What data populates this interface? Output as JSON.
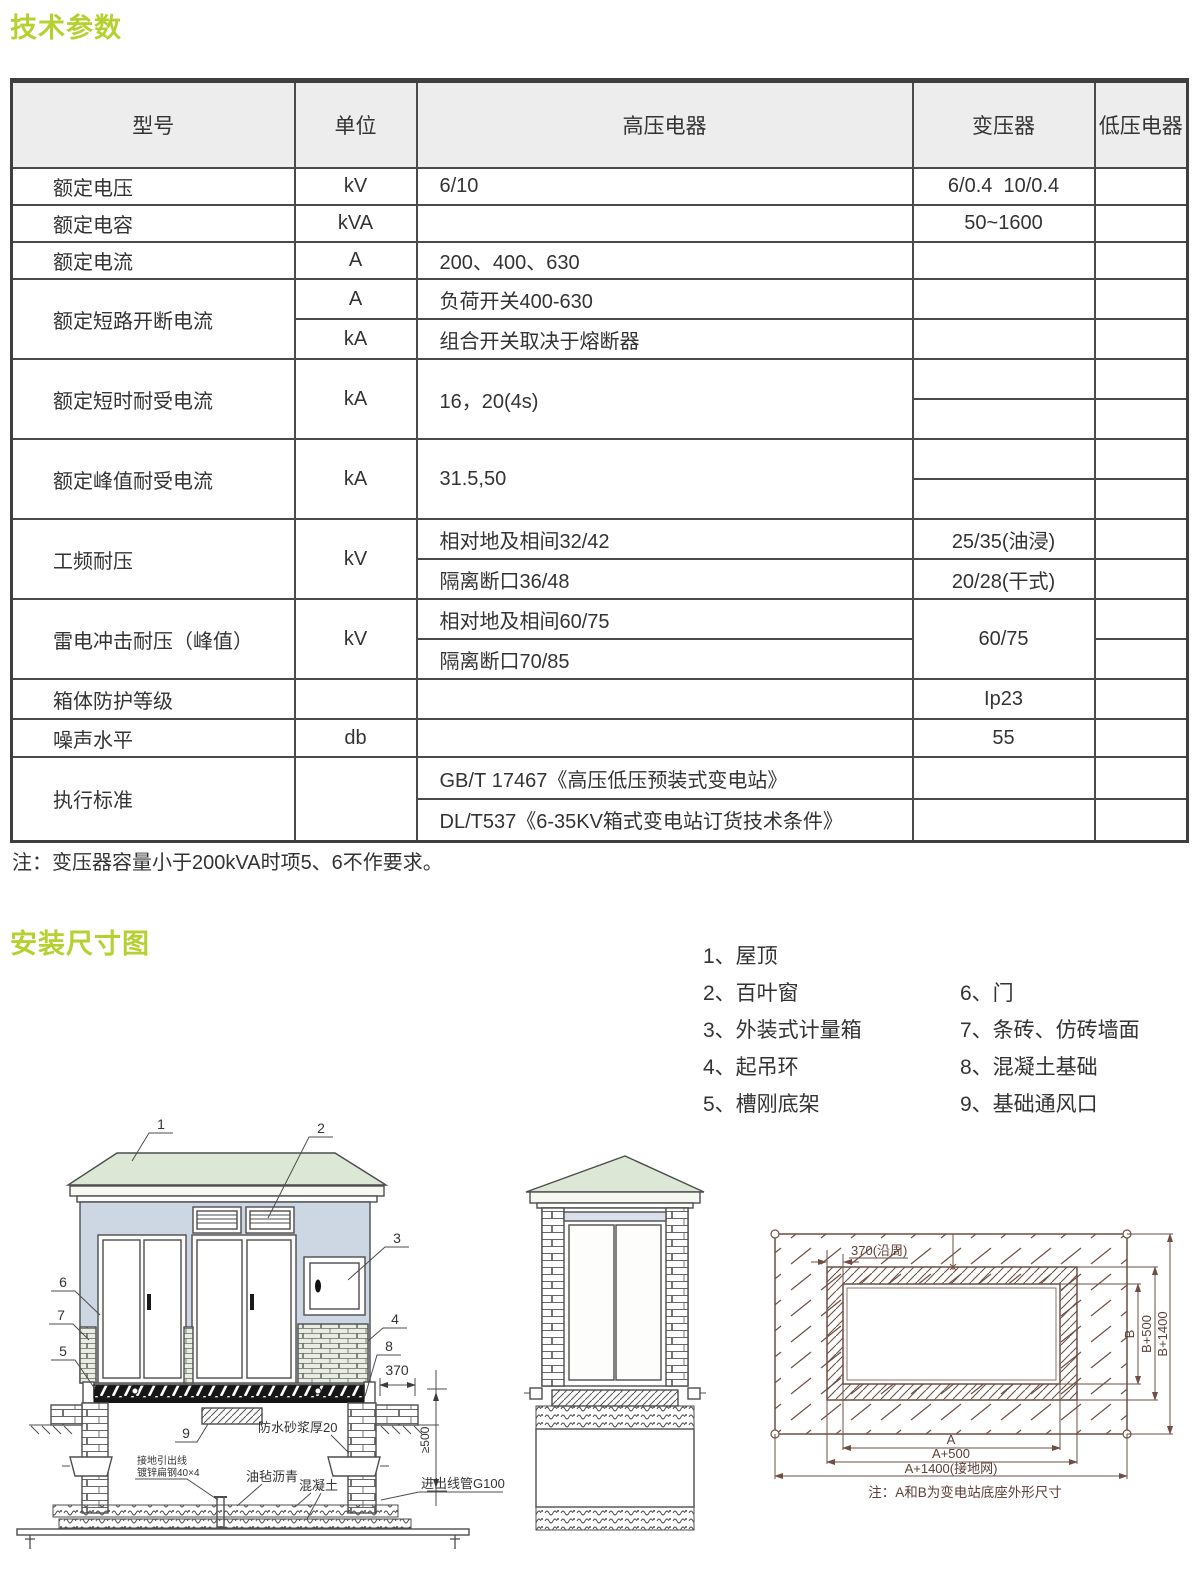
{
  "page": {
    "title1": "技术参数",
    "title2": "安装尺寸图",
    "table_note": "注：变压器容量小于200kVA时项5、6不作要求。"
  },
  "table": {
    "headers": [
      "型号",
      "单位",
      "高压电器",
      "变压器",
      "低压电器"
    ],
    "rated_voltage": {
      "name": "额定电压",
      "unit": "kV",
      "hv": "6/10",
      "tx": "6/0.4  10/0.4"
    },
    "rated_capacity": {
      "name": "额定电容",
      "unit": "kVA",
      "tx": "50~1600"
    },
    "rated_current": {
      "name": "额定电流",
      "unit": "A",
      "hv": "200、400、630"
    },
    "rated_breaking": {
      "name": "额定短路开断电流",
      "unit_a": "A",
      "hv_a": "负荷开关400-630",
      "unit_b": "kA",
      "hv_b": "组合开关取决于熔断器"
    },
    "short_time": {
      "name": "额定短时耐受电流",
      "unit": "kA",
      "hv": "16，20(4s)"
    },
    "peak": {
      "name": "额定峰值耐受电流",
      "unit": "kA",
      "hv": "31.5,50"
    },
    "power_freq": {
      "name": "工频耐压",
      "unit": "kV",
      "hv_a": "相对地及相间32/42",
      "tx_a": "25/35(油浸)",
      "hv_b": "隔离断口36/48",
      "tx_b": "20/28(干式)"
    },
    "lightning": {
      "name": "雷电冲击耐压（峰值）",
      "unit": "kV",
      "hv_a": "相对地及相间60/75",
      "hv_b": "隔离断口70/85",
      "tx": "60/75"
    },
    "protection": {
      "name": "箱体防护等级",
      "tx": "Ip23"
    },
    "noise": {
      "name": "噪声水平",
      "unit": "db",
      "tx": "55"
    },
    "standards": {
      "name": "执行标准",
      "hv_a": "GB/T 17467《高压低压预装式变电站》",
      "hv_b": "DL/T537《6-35KV箱式变电站订货技术条件》"
    }
  },
  "legend": {
    "items_left": [
      "1、屋顶",
      "2、百叶窗",
      "3、外装式计量箱",
      "4、起吊环",
      "5、槽刚底架"
    ],
    "items_right": [
      "6、门",
      "7、条砖、仿砖墙面",
      "8、混凝土基础",
      "9、基础通风口"
    ]
  },
  "front_drawing": {
    "callout_1": "1",
    "callout_2": "2",
    "callout_3": "3",
    "callout_4": "4",
    "callout_5": "5",
    "callout_6": "6",
    "callout_7": "7",
    "callout_8": "8",
    "callout_9": "9",
    "dim_370": "370",
    "dim_500": "≥500",
    "ann_waterproof": "防水砂浆厚20",
    "ann_ground_line1": "接地引出线",
    "ann_ground_line2": "镀锌扁钢40×4",
    "ann_felt": "油毡沥青",
    "ann_concrete": "混凝土",
    "ann_conduit": "进出线管G100"
  },
  "plan_drawing": {
    "dim_370": "370(沿周)",
    "dim_b": "B",
    "dim_b500": "B+500",
    "dim_b1400": "B+1400",
    "dim_a": "A",
    "dim_a500": "A+500",
    "dim_a1400": "A+1400(接地网)",
    "note": "注：A和B为变电站底座外形尺寸"
  },
  "colors": {
    "accent": "#b5d02f",
    "table_border": "#4a4a4a",
    "header_bg": "#ededed",
    "roof": "#dce8d5",
    "wall": "#cdd6e3",
    "drawing_line": "#6f4f44"
  }
}
